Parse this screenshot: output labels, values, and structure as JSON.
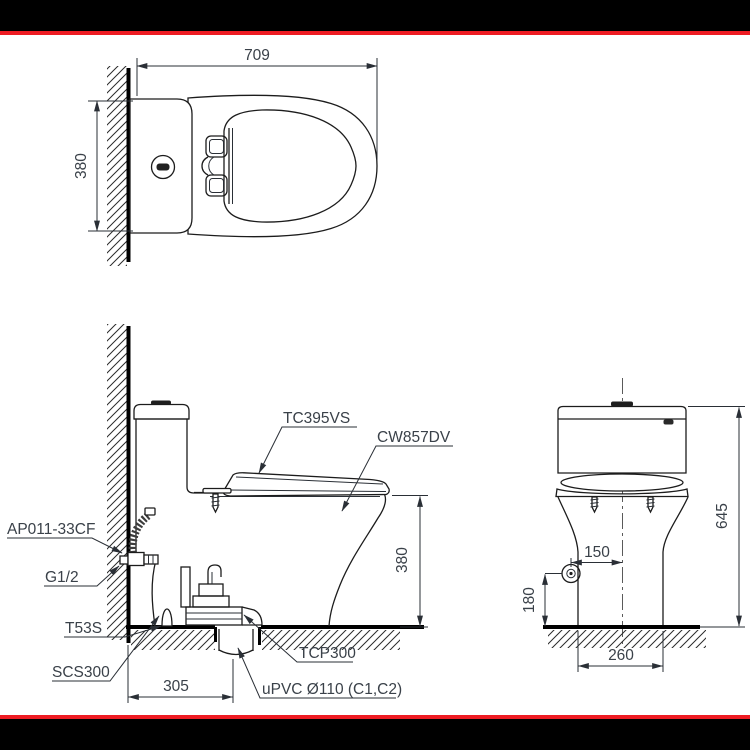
{
  "drawing": {
    "type": "toilet-installation-technical-drawing",
    "views": [
      "plan",
      "side-elevation",
      "front-elevation"
    ]
  },
  "labels": {
    "tc395vs": "TC395VS",
    "cw857dv": "CW857DV",
    "ap011": "AP011-33CF",
    "g12": "G1/2",
    "t53s": "T53S",
    "scs300": "SCS300",
    "tcp300": "TCP300",
    "upvc": "uPVC Ø110 (C1,C2)"
  },
  "dimensions": {
    "top_width": "709",
    "top_depth": "380",
    "side_seat_height": "380",
    "side_outlet_offset": "305",
    "front_height": "645",
    "front_supply_offset": "150",
    "front_supply_height": "180",
    "front_base_width": "260"
  },
  "colors": {
    "banner_black": "#000000",
    "banner_red": "#ee1c23",
    "line": "#1c1c1c",
    "text": "#3a4149"
  }
}
